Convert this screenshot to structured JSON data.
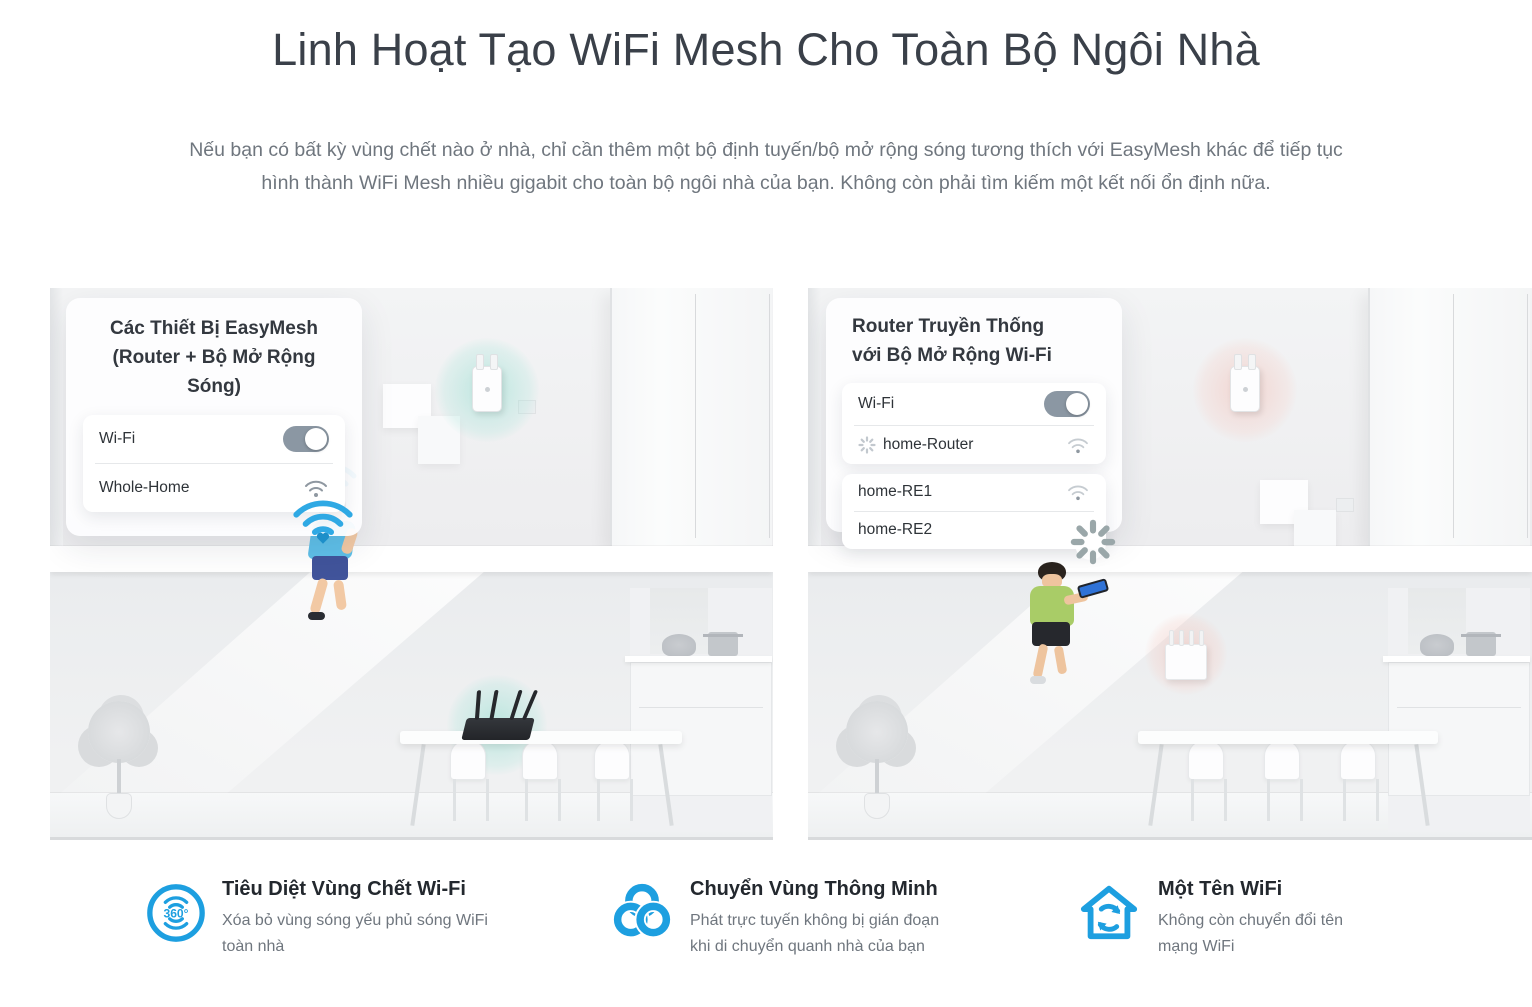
{
  "header": {
    "title": "Linh Hoạt Tạo WiFi Mesh Cho Toàn Bộ Ngôi Nhà",
    "description": "Nếu bạn có bất kỳ vùng chết nào ở nhà, chỉ cần thêm một bộ định tuyến/bộ mở rộng sóng tương thích với EasyMesh khác để tiếp tục hình thành WiFi Mesh nhiều gigabit cho toàn bộ ngôi nhà của bạn. Không còn phải tìm kiếm một kết nối ổn định nữa."
  },
  "scenes": {
    "left": {
      "card": {
        "title_line1": "Các Thiết Bị EasyMesh",
        "title_line2": "(Router + Bộ Mở Rộng",
        "title_line3": "Sóng)",
        "wifi_label": "Wi-Fi",
        "network_name": "Whole-Home"
      }
    },
    "right": {
      "card": {
        "title_line1": "Router Truyền Thống",
        "title_line2": "với Bộ Mở Rộng Wi-Fi",
        "wifi_label": "Wi-Fi",
        "router_ssid": "home-Router",
        "extender1_ssid": "home-RE1",
        "extender2_ssid": "home-RE2"
      }
    }
  },
  "features": [
    {
      "icon": "coverage-360-icon",
      "icon_label": "360°",
      "title": "Tiêu Diệt Vùng Chết Wi-Fi",
      "description": "Xóa bỏ vùng sóng yếu phủ sóng WiFi toàn nhà"
    },
    {
      "icon": "smart-roaming-icon",
      "title": "Chuyển Vùng Thông Minh",
      "description": "Phát trực tuyến không bị gián đoạn khi di chuyển quanh nhà của bạn"
    },
    {
      "icon": "single-wifi-name-icon",
      "title": "Một Tên WiFi",
      "description": "Không còn chuyển đổi tên mạng WiFi"
    }
  ],
  "colors": {
    "accent_blue": "#1d9fe0",
    "good_glow": "#bfeae2",
    "bad_glow": "#f6d6d0",
    "toggle_on": "#8b97a3"
  }
}
